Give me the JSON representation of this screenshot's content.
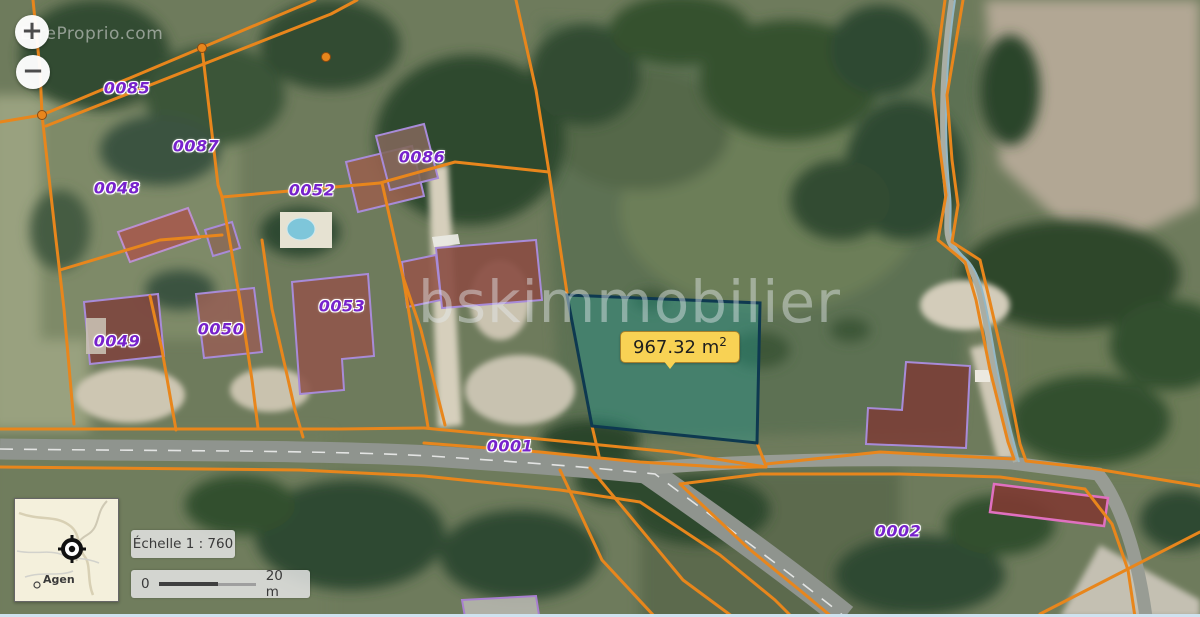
{
  "watermarks": {
    "corner": "EtreProprio.com",
    "center": "bskimmobilier"
  },
  "zoom_controls": {
    "zoom_in": "+",
    "zoom_out": "−"
  },
  "parcels": [
    {
      "id": "0085",
      "x": 127,
      "y": 88
    },
    {
      "id": "0087",
      "x": 196,
      "y": 146
    },
    {
      "id": "0048",
      "x": 117,
      "y": 188
    },
    {
      "id": "0052",
      "x": 312,
      "y": 190
    },
    {
      "id": "0086",
      "x": 422,
      "y": 157
    },
    {
      "id": "0049",
      "x": 117,
      "y": 341
    },
    {
      "id": "0050",
      "x": 221,
      "y": 329
    },
    {
      "id": "0053",
      "x": 342,
      "y": 306
    },
    {
      "id": "0001",
      "x": 510,
      "y": 446
    },
    {
      "id": "0002",
      "x": 898,
      "y": 531
    }
  ],
  "highlighted_parcel": {
    "area_text": "967.32 m",
    "area_exponent": "2"
  },
  "scale_panel": {
    "scale_label": "Échelle 1 : 760",
    "bar_start": "0",
    "bar_end": "20 m"
  },
  "minimap": {
    "city_label": "Agen"
  },
  "colors": {
    "cadastre_line": "#E8861C",
    "parcel_label_text": "#7722CC",
    "highlight_stroke": "#0E3950",
    "highlight_fill": "rgba(35,150,142,0.42)",
    "area_label_bg": "#F8D254"
  }
}
